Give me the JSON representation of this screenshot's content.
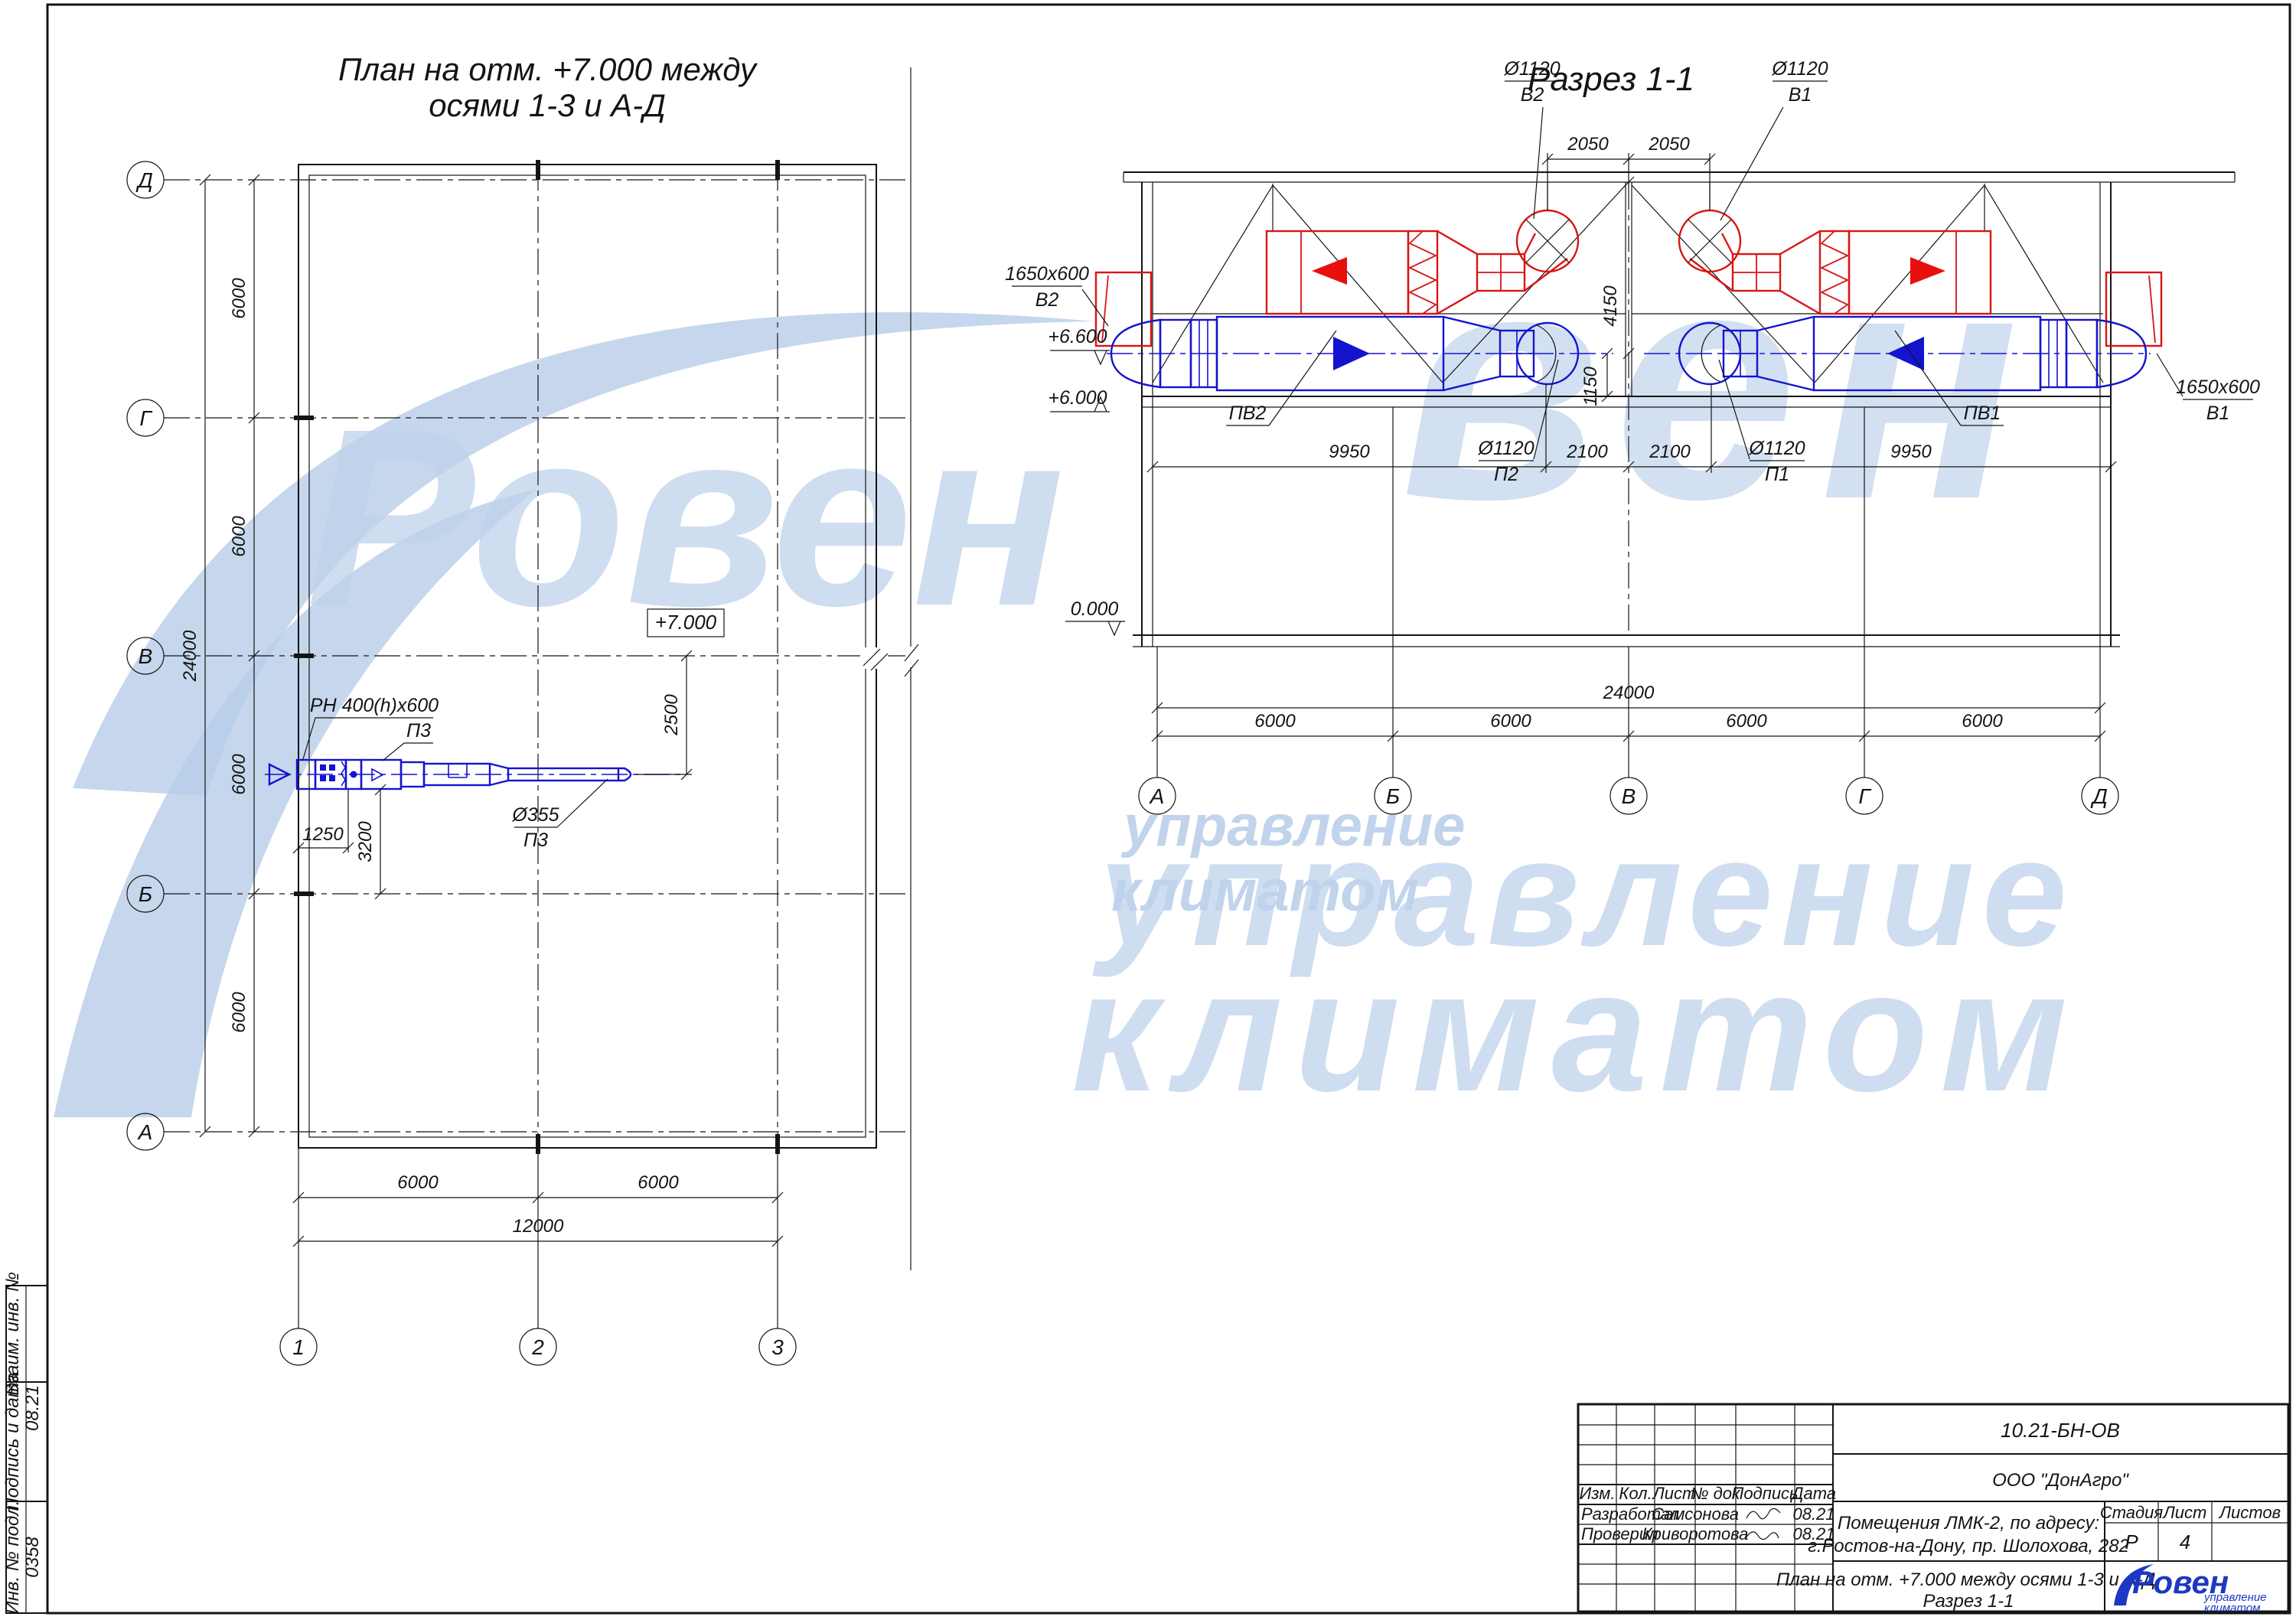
{
  "colors": {
    "line_black": "#141414",
    "equip_red": "#d81515",
    "equip_blue": "#1414cf",
    "watermark_blue": "#b7cde9",
    "logo_blue": "#1d38c2"
  },
  "plan": {
    "title_line1": "План на отм. +7.000 между",
    "title_line2": "осями 1-3 и А-Д",
    "axes_rows": [
      "Д",
      "Г",
      "В",
      "Б",
      "А"
    ],
    "axes_cols": [
      "1",
      "2",
      "3"
    ],
    "dim_total_v": "24000",
    "dims_v": [
      "6000",
      "6000",
      "6000",
      "6000"
    ],
    "dims_bottom": [
      "6000",
      "6000"
    ],
    "dim_bottom_total": "12000",
    "elev_box": "+7.000",
    "label_grille": "РН 400(h)x600",
    "label_p3_top": "П3",
    "label_duct_dia": "Ø355",
    "label_p3_bottom": "П3",
    "dim_1250": "1250",
    "dim_3200": "3200",
    "dim_2500": "2500"
  },
  "section": {
    "title": "Разрез 1-1",
    "axes": [
      "А",
      "Б",
      "В",
      "Г",
      "Д"
    ],
    "dims_top": [
      "2050",
      "2050"
    ],
    "lbl_v2_dia": "Ø1120",
    "lbl_v2": "В2",
    "lbl_v1_dia": "Ø1120",
    "lbl_v1": "В1",
    "lbl_out2_size": "1650x600",
    "lbl_out2": "В2",
    "lbl_out1_size": "1650x600",
    "lbl_out1": "В1",
    "lbl_pv2": "ПВ2",
    "lbl_pv1": "ПВ1",
    "lbl_p2_dia": "Ø1120",
    "lbl_p2": "П2",
    "lbl_p1_dia": "Ø1120",
    "lbl_p1": "П1",
    "elev_66": "+6.600",
    "elev_60": "+6.000",
    "elev_0": "0.000",
    "dim_4150": "4150",
    "dim_1150": "1150",
    "dims_mid": [
      "9950",
      "2100",
      "2100",
      "9950"
    ],
    "dim_total": "24000",
    "dims_bottom": [
      "6000",
      "6000",
      "6000",
      "6000"
    ]
  },
  "frame": {
    "stamp": [
      {
        "label": "Взаим. инв. №",
        "value": ""
      },
      {
        "label": "Подпись и дата",
        "value": "08.21"
      },
      {
        "label": "Инв. № подл.",
        "value": "0358"
      }
    ]
  },
  "titleblock": {
    "doc_number": "10.21-БН-ОВ",
    "company": "ООО \"ДонАгро\"",
    "cols": [
      "Изм.",
      "Кол.",
      "Лист",
      "№ док",
      "Подпись",
      "Дата"
    ],
    "row1_role": "Разработал",
    "row1_name": "Самсонова",
    "row1_date": "08.21",
    "row2_role": "Проверил",
    "row2_name": "Криворотова",
    "row2_date": "08.21",
    "object_line1": "Помещения ЛМК-2, по адресу:",
    "object_line2": "г.Ростов-на-Дону, пр. Шолохова, 282",
    "stage_h": "Стадия",
    "sheet_h": "Лист",
    "sheets_h": "Листов",
    "stage_v": "Р",
    "sheet_v": "4",
    "sheets_v": "",
    "footer_line1": "План на отм. +7.000  между осями 1-3 и А-Д.",
    "footer_line2": "Разрез 1-1",
    "logo_text": "Ровен",
    "logo_sub1": "управление",
    "logo_sub2": "климатом"
  },
  "watermark": {
    "roven": "Ровен",
    "ven": "вен",
    "upr_small": "управление",
    "klim_small": "климатом",
    "upr_big": "управление",
    "klim_big": "климатом"
  }
}
